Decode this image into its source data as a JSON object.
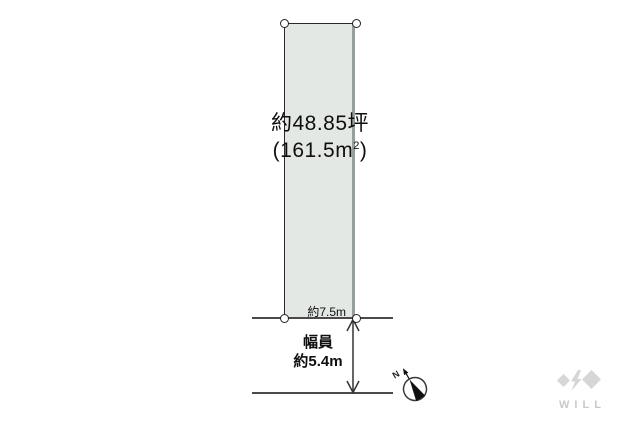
{
  "diagram": {
    "title": "land-plot-diagram",
    "plot": {
      "area_tsubo": "約48.85坪",
      "area_m2_open": "(161.5m",
      "area_m2_sup": "2",
      "area_m2_close": ")",
      "frontage_label": "約7.5m"
    },
    "road": {
      "width_label_line1": "幅員",
      "width_label_line2": "約5.4m"
    },
    "compass": {
      "north": "N"
    },
    "logo": {
      "text": "WILL"
    },
    "colors": {
      "plot_fill": "#e3e8e4",
      "plot_outline": "#2a2a2a",
      "plot_right_edge": "#98a09a",
      "road_line": "#4a4a4a",
      "arrow": "#333333",
      "logo_shape": "#d6d6d6",
      "logo_text": "#c9c9c9"
    }
  }
}
